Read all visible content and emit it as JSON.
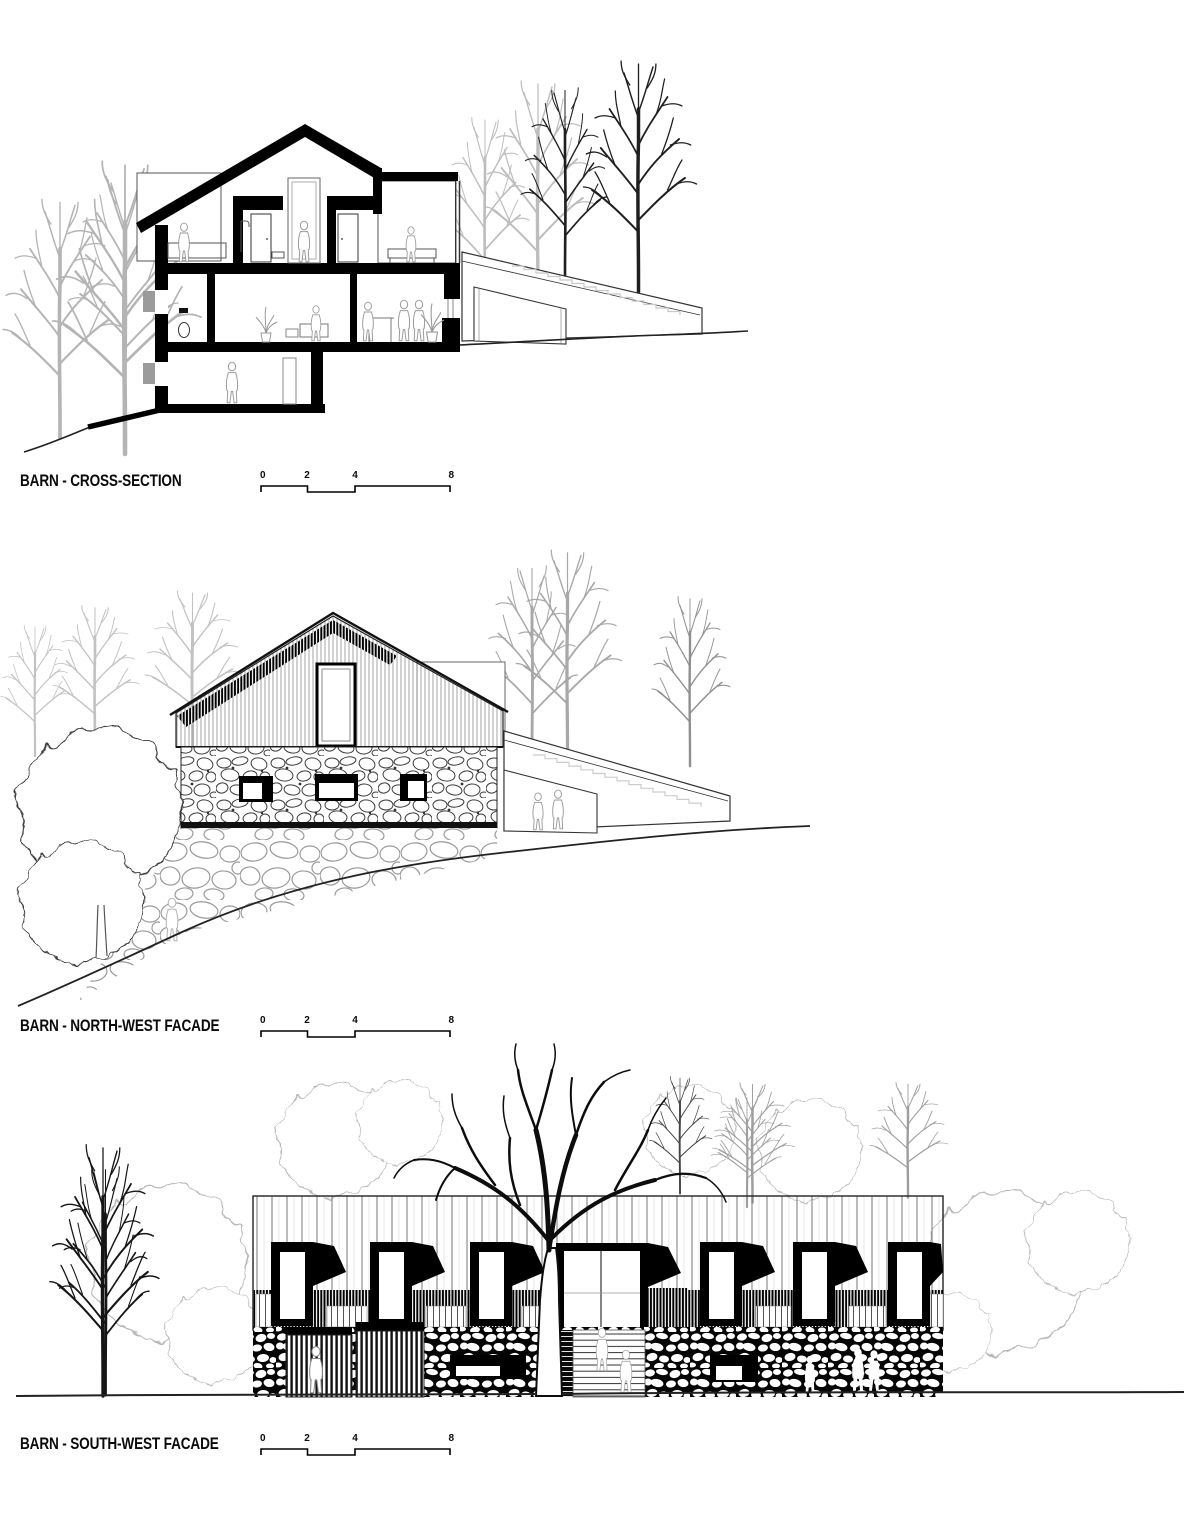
{
  "sheet": {
    "background": "#ffffff",
    "ink": "#000000",
    "light_tree_gray": "#b5b5b5",
    "mid_gray": "#8a8a8a"
  },
  "drawings": [
    {
      "id": "cross-section",
      "title": "BARN - CROSS-SECTION",
      "scale_bar": {
        "ticks": [
          "0",
          "2",
          "4",
          "8"
        ]
      }
    },
    {
      "id": "north-west-facade",
      "title": "BARN - NORTH-WEST FACADE",
      "scale_bar": {
        "ticks": [
          "0",
          "2",
          "4",
          "8"
        ]
      }
    },
    {
      "id": "south-west-facade",
      "title": "BARN - SOUTH-WEST FACADE",
      "scale_bar": {
        "ticks": [
          "0",
          "2",
          "4",
          "8"
        ]
      }
    }
  ]
}
